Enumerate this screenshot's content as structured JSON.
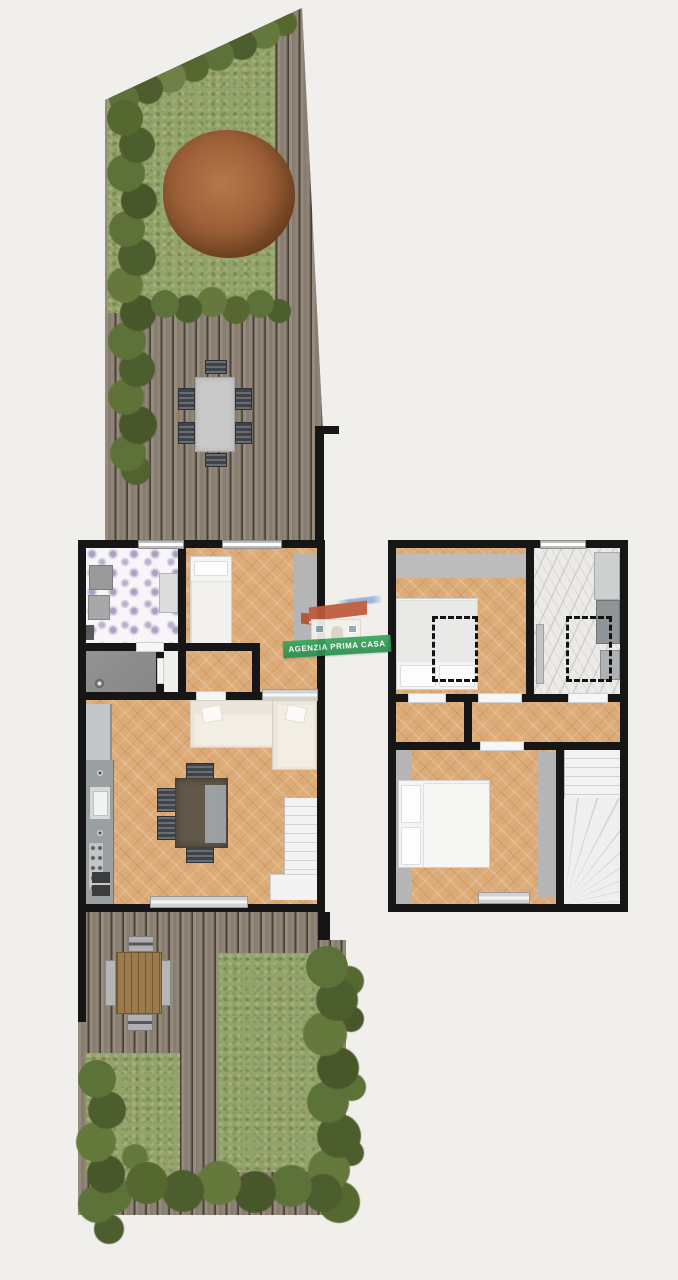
{
  "watermark": {
    "label": "AGENZIA PRIMA CASA"
  },
  "palette": {
    "background": "#f0efeb",
    "wall": "#161616",
    "deck_wood": "#8b8174",
    "deck_gap": "#4a4238",
    "grass": "#94a369",
    "hedge_dark": "#4c5e2e",
    "hedge_mid": "#5d7239",
    "hedge_light": "#6e8247",
    "autumn_tree": "#a2633a",
    "wood_floor": "#dcab77",
    "floral_tile": "#f7f5f8",
    "floral_flower": "#b3a7c6",
    "utility_gray_floor": "#8f8f8f",
    "marble": "#eceae6",
    "fixture_gray": "#9aa0a2",
    "sofa_cream": "#ece6da",
    "dining_table_brown": "#61584a",
    "outdoor_table_gray": "#c9c9c9",
    "outdoor_table_brown": "#9b7b4c",
    "chair_dark": "#3f444a",
    "stairs_white": "#f0f0f0",
    "bed_white": "#f4f4f3",
    "door_light": "#e0e0e0",
    "brand_green": "#3aa65e",
    "brand_roof": "#bf5a3c"
  }
}
